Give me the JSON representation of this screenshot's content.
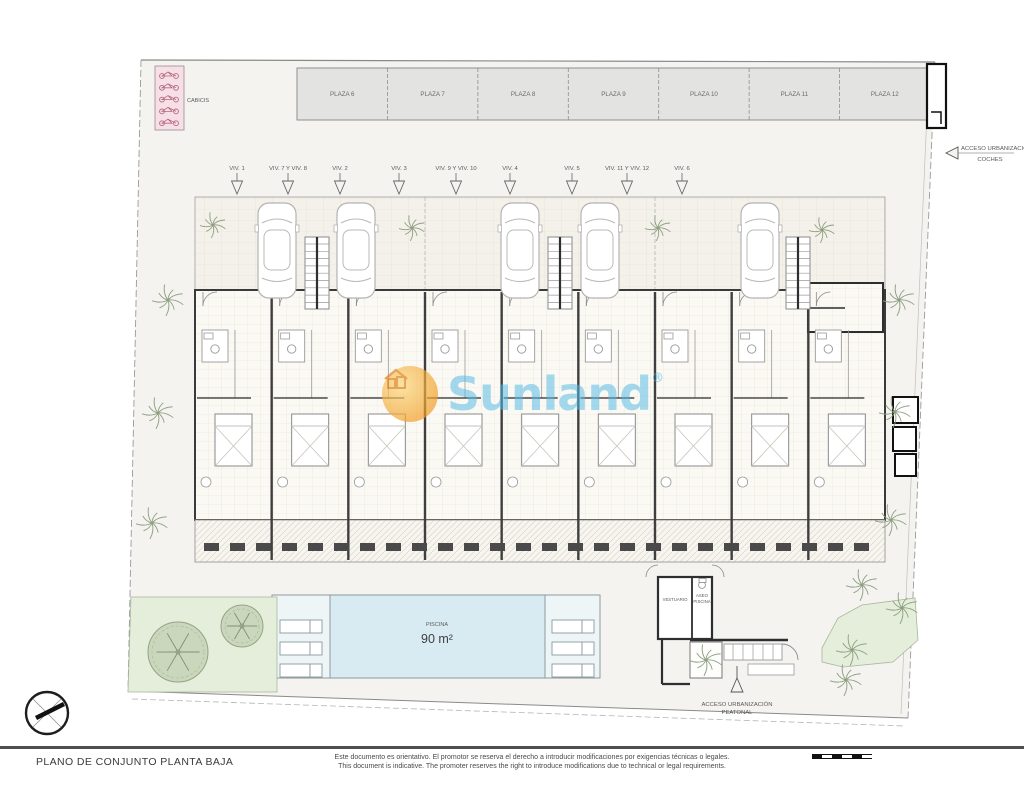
{
  "watermark": {
    "brand": "Sunland",
    "registered": "®",
    "blue": "#52b9e6",
    "orange": "#f3a32c"
  },
  "parking": {
    "plaza_labels": [
      "PLAZA 6",
      "PLAZA 7",
      "PLAZA 8",
      "PLAZA 9",
      "PLAZA 10",
      "PLAZA 11",
      "PLAZA 12"
    ],
    "bike_label": "CABICIS"
  },
  "units": [
    {
      "label": "VIV. 1",
      "x": 237
    },
    {
      "label": "VIV. 7 Y VIV. 8",
      "x": 288
    },
    {
      "label": "VIV. 2",
      "x": 340
    },
    {
      "label": "VIV. 3",
      "x": 399
    },
    {
      "label": "VIV. 9 Y VIV. 10",
      "x": 456
    },
    {
      "label": "VIV. 4",
      "x": 510
    },
    {
      "label": "VIV. 5",
      "x": 572
    },
    {
      "label": "VIV. 11 Y VIV. 12",
      "x": 627
    },
    {
      "label": "VIV. 6",
      "x": 682
    }
  ],
  "pool": {
    "label": "PISCINA",
    "area": "90 m²"
  },
  "facilities": {
    "vestuario": "VESTUARIO",
    "aseo_line1": "ASEO",
    "aseo_line2": "PISCINA"
  },
  "access": {
    "cars_line1": "ACCESO URBANIZACIÓN",
    "cars_line2": "COCHES",
    "ped_line1": "ACCESO URBANIZACIÓN",
    "ped_line2": "PEATONAL"
  },
  "titleblock": {
    "title": "PLANO DE CONJUNTO PLANTA BAJA",
    "disclaimer_es": "Este documento es orientativo. El promotor se reserva el derecho a introducir modificaciones por exigencias técnicas o legales.",
    "disclaimer_en": "This document is indicative. The promoter reserves the right to introduce modifications due to technical or legal requirements."
  },
  "plan": {
    "cars_x": [
      277,
      356,
      520,
      600,
      760
    ],
    "stairs_x": [
      317,
      560,
      798
    ],
    "garage_palms": [
      [
        213,
        225
      ],
      [
        412,
        228
      ],
      [
        658,
        228
      ],
      [
        822,
        230
      ]
    ],
    "site_palms": [
      [
        168,
        300
      ],
      [
        158,
        413
      ],
      [
        152,
        523
      ],
      [
        899,
        300
      ],
      [
        895,
        412
      ],
      [
        891,
        520
      ],
      [
        862,
        585
      ],
      [
        852,
        650
      ],
      [
        902,
        608
      ],
      [
        846,
        680
      ],
      [
        706,
        660
      ]
    ],
    "round_trees": [
      [
        178,
        652,
        30
      ],
      [
        242,
        626,
        21
      ]
    ],
    "loungers_left_x": 280,
    "loungers_right_x": 552,
    "colors": {
      "pool": "#d9ebf2",
      "deck": "#eef5f7",
      "green": "#e5eedb",
      "plaza": "#e3e3e1",
      "bike": "#f7dfe8",
      "site": "#f4f3f0"
    }
  }
}
